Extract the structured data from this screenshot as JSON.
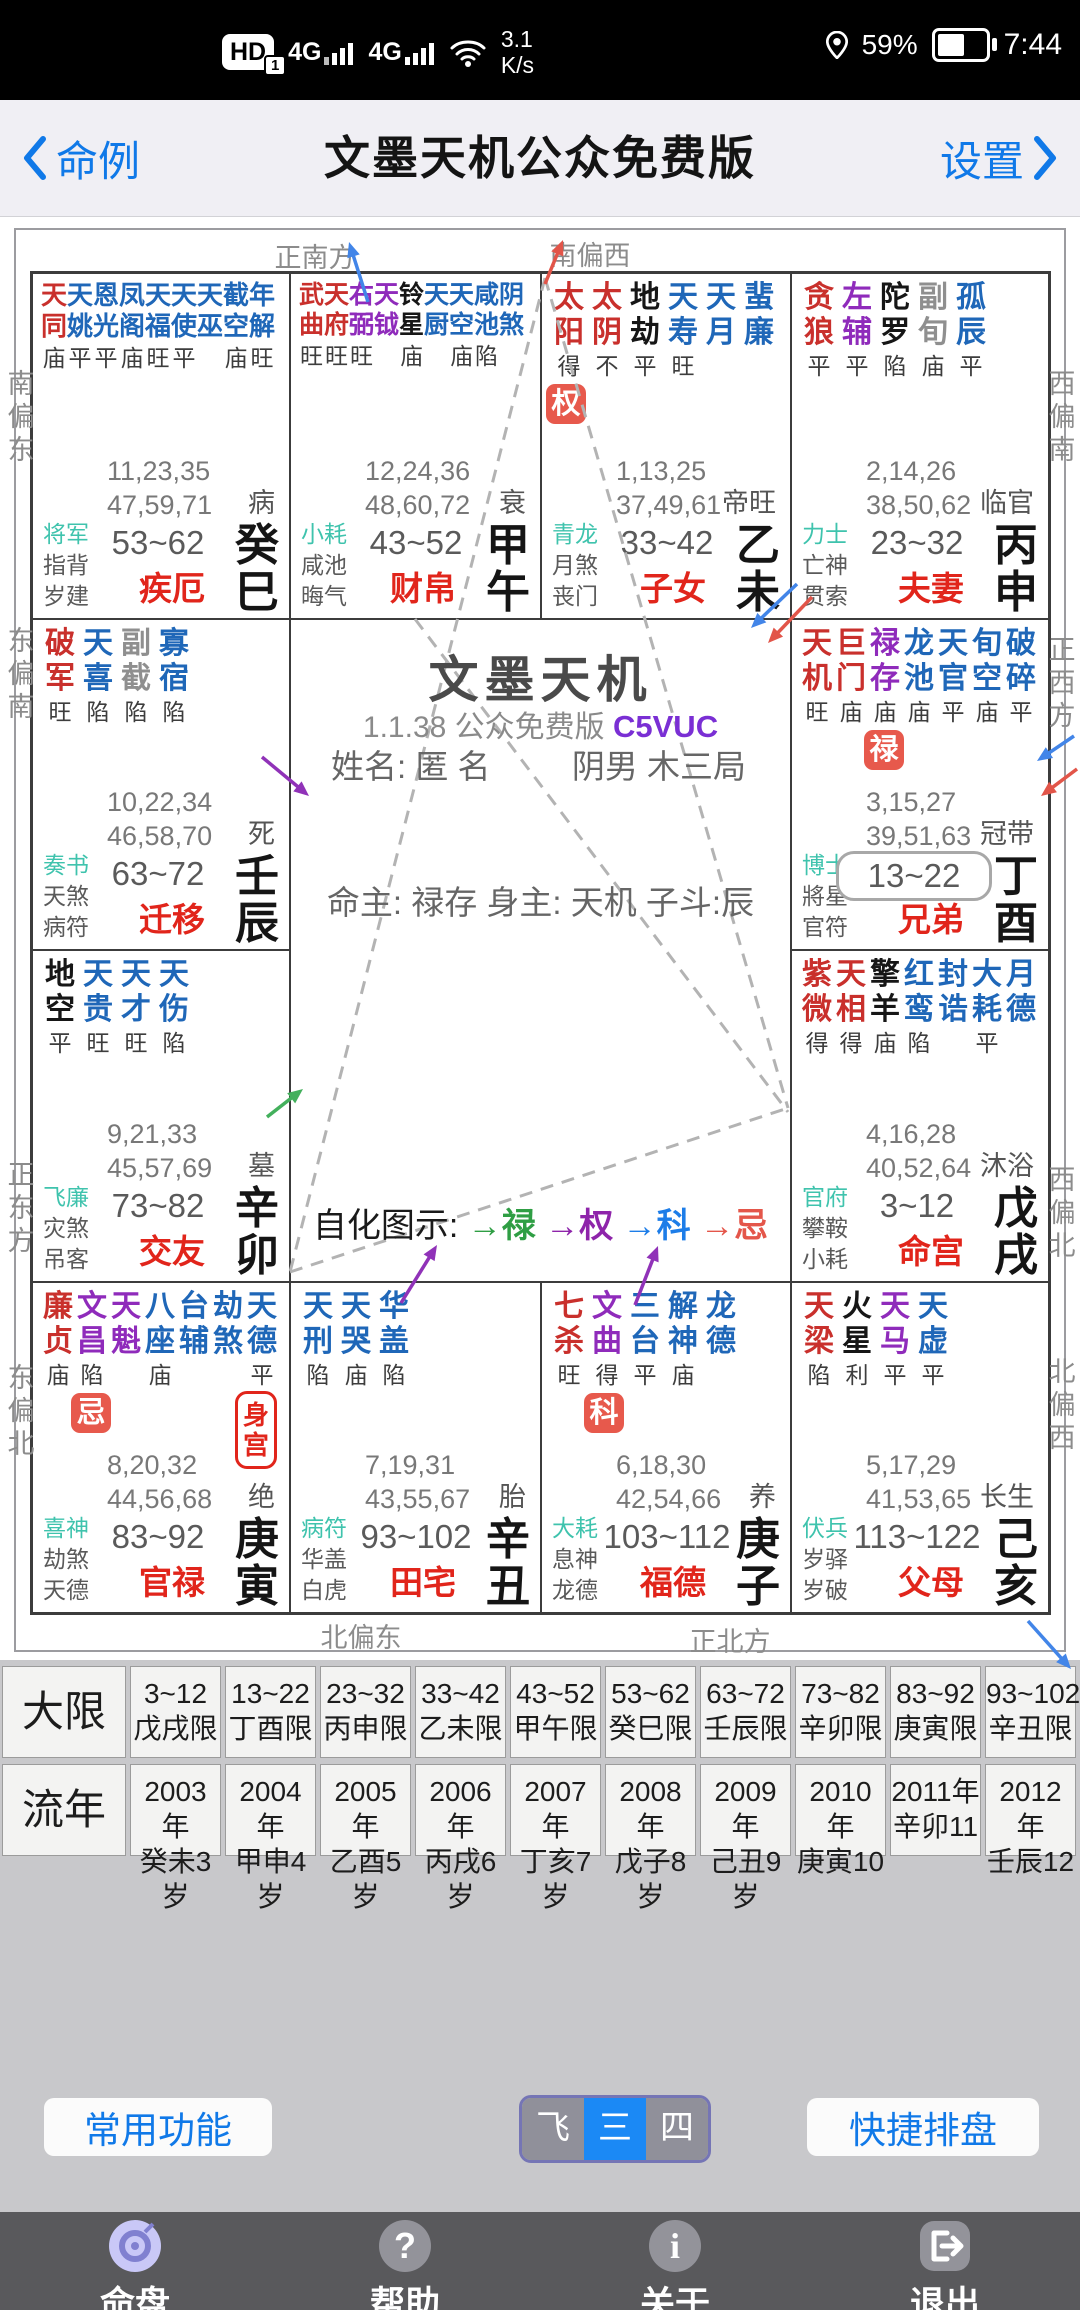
{
  "status_bar": {
    "hd": "HD",
    "hd_sub": "1",
    "net1": "4G",
    "net2": "4G",
    "speed_top": "3.1",
    "speed_bottom": "K/s",
    "battery_pct": "59%",
    "time": "7:44"
  },
  "header": {
    "back": "命例",
    "title": "文墨天机公众免费版",
    "settings": "设置"
  },
  "compass": {
    "top": [
      "正南方",
      "南偏西"
    ],
    "bottom": [
      "北偏东",
      "正北方"
    ],
    "left": [
      "南偏东",
      "东偏南",
      "正东方",
      "东偏北"
    ],
    "right": [
      "西偏南",
      "正西方",
      "西偏北",
      "北偏西"
    ]
  },
  "center": {
    "app_title": "文墨天机",
    "version": "1.1.38 公众免费版",
    "code": "C5VUC",
    "name_label": "姓名:",
    "name": "匿 名",
    "gender": "阴男 木三局",
    "ming_line": "命主: 禄存 身主: 天机 子斗:辰",
    "sihua_label": "自化图示:",
    "sihua": [
      {
        "t": "禄",
        "c": "#2f9e44"
      },
      {
        "t": "权",
        "c": "#8e24aa"
      },
      {
        "t": "科",
        "c": "#1d7de8"
      },
      {
        "t": "忌",
        "c": "#e4564a"
      }
    ]
  },
  "palaces": [
    {
      "key": "si",
      "stars": [
        [
          "天同",
          "r",
          "庙"
        ],
        [
          "天姚",
          "b",
          "平"
        ],
        [
          "恩光",
          "b",
          "平"
        ],
        [
          "凤阁",
          "b",
          "庙"
        ],
        [
          "天福",
          "b",
          "旺"
        ],
        [
          "天使",
          "b",
          "平"
        ],
        [
          "天巫",
          "b",
          ""
        ],
        [
          "截空",
          "b",
          "庙"
        ],
        [
          "年解",
          "b",
          "旺"
        ]
      ],
      "nums": [
        "11,23,35",
        "47,59,71"
      ],
      "stage": "病",
      "gods": [
        "将军",
        "指背",
        "岁建"
      ],
      "age": "53~62",
      "palace": "疾厄",
      "gz": "癸巳"
    },
    {
      "key": "wu",
      "stars": [
        [
          "武曲",
          "r",
          "旺"
        ],
        [
          "天府",
          "r",
          "旺"
        ],
        [
          "右弼",
          "p",
          "旺"
        ],
        [
          "天钺",
          "p",
          ""
        ],
        [
          "铃星",
          "k",
          "庙"
        ],
        [
          "天厨",
          "b",
          ""
        ],
        [
          "天空",
          "b",
          "庙"
        ],
        [
          "咸池",
          "b",
          "陷"
        ],
        [
          "阴煞",
          "b",
          ""
        ]
      ],
      "nums": [
        "12,24,36",
        "48,60,72"
      ],
      "stage": "衰",
      "gods": [
        "小耗",
        "咸池",
        "晦气"
      ],
      "age": "43~52",
      "palace": "财帛",
      "gz": "甲午"
    },
    {
      "key": "wei",
      "stars": [
        [
          "太阳",
          "r",
          "得"
        ],
        [
          "太阴",
          "r",
          "不"
        ],
        [
          "地劫",
          "k",
          "平"
        ],
        [
          "天寿",
          "b",
          "旺"
        ],
        [
          "天月",
          "b",
          ""
        ],
        [
          "蜚廉",
          "b",
          ""
        ]
      ],
      "badge": {
        "t": "权",
        "col": 0
      },
      "nums": [
        "1,13,25",
        "37,49,61"
      ],
      "stage": "帝旺",
      "gods": [
        "青龙",
        "月煞",
        "丧门"
      ],
      "age": "33~42",
      "palace": "子女",
      "gz": "乙未"
    },
    {
      "key": "shen",
      "stars": [
        [
          "贪狼",
          "r",
          "平"
        ],
        [
          "左辅",
          "p",
          "平"
        ],
        [
          "陀罗",
          "k",
          "陷"
        ],
        [
          "副旬",
          "g",
          "庙"
        ],
        [
          "孤辰",
          "b",
          "平"
        ]
      ],
      "nums": [
        "2,14,26",
        "38,50,62"
      ],
      "stage": "临官",
      "gods": [
        "力士",
        "亡神",
        "贯索"
      ],
      "age": "23~32",
      "palace": "夫妻",
      "gz": "丙申"
    },
    {
      "key": "chen",
      "stars": [
        [
          "破军",
          "r",
          "旺"
        ],
        [
          "天喜",
          "b",
          "陷"
        ],
        [
          "副截",
          "g",
          "陷"
        ],
        [
          "寡宿",
          "b",
          "陷"
        ]
      ],
      "nums": [
        "10,22,34",
        "46,58,70"
      ],
      "stage": "死",
      "gods": [
        "奏书",
        "天煞",
        "病符"
      ],
      "age": "63~72",
      "palace": "迁移",
      "gz": "壬辰"
    },
    {
      "key": "you",
      "stars": [
        [
          "天机",
          "r",
          "旺"
        ],
        [
          "巨门",
          "r",
          "庙"
        ],
        [
          "禄存",
          "p",
          "庙"
        ],
        [
          "龙池",
          "b",
          "庙"
        ],
        [
          "天官",
          "b",
          "平"
        ],
        [
          "旬空",
          "b",
          "庙"
        ],
        [
          "破碎",
          "b",
          "平"
        ]
      ],
      "badge": {
        "t": "禄",
        "col": 2
      },
      "age_box": true,
      "nums": [
        "3,15,27",
        "39,51,63"
      ],
      "stage": "冠带",
      "gods": [
        "博士",
        "將星",
        "官符"
      ],
      "age": "13~22",
      "palace": "兄弟",
      "gz": "丁酉"
    },
    {
      "key": "mao",
      "stars": [
        [
          "地空",
          "k",
          "平"
        ],
        [
          "天贵",
          "b",
          "旺"
        ],
        [
          "天才",
          "b",
          "旺"
        ],
        [
          "天伤",
          "b",
          "陷"
        ]
      ],
      "nums": [
        "9,21,33",
        "45,57,69"
      ],
      "stage": "墓",
      "gods": [
        "飞廉",
        "灾煞",
        "吊客"
      ],
      "age": "73~82",
      "palace": "交友",
      "gz": "辛卯"
    },
    {
      "key": "xu",
      "stars": [
        [
          "紫微",
          "r",
          "得"
        ],
        [
          "天相",
          "r",
          "得"
        ],
        [
          "擎羊",
          "k",
          "庙"
        ],
        [
          "红鸾",
          "b",
          "陷"
        ],
        [
          "封诰",
          "b",
          ""
        ],
        [
          "大耗",
          "b",
          "平"
        ],
        [
          "月德",
          "b",
          ""
        ]
      ],
      "nums": [
        "4,16,28",
        "40,52,64"
      ],
      "stage": "沐浴",
      "gods": [
        "官府",
        "攀鞍",
        "小耗"
      ],
      "age": "3~12",
      "palace": "命宫",
      "gz": "戊戌"
    },
    {
      "key": "yin",
      "stars": [
        [
          "廉贞",
          "r",
          "庙"
        ],
        [
          "文昌",
          "p",
          "陷"
        ],
        [
          "天魁",
          "p",
          ""
        ],
        [
          "八座",
          "b",
          "庙"
        ],
        [
          "台辅",
          "b",
          ""
        ],
        [
          "劫煞",
          "b",
          ""
        ],
        [
          "天德",
          "b",
          "平"
        ]
      ],
      "badge": {
        "t": "忌",
        "col": 1
      },
      "shen_gong": "身宫",
      "nums": [
        "8,20,32",
        "44,56,68"
      ],
      "stage": "绝",
      "gods": [
        "喜神",
        "劫煞",
        "天德"
      ],
      "age": "83~92",
      "palace": "官禄",
      "gz": "庚寅"
    },
    {
      "key": "chou",
      "stars": [
        [
          "天刑",
          "b",
          "陷"
        ],
        [
          "天哭",
          "b",
          "庙"
        ],
        [
          "华盖",
          "b",
          "陷"
        ]
      ],
      "nums": [
        "7,19,31",
        "43,55,67"
      ],
      "stage": "胎",
      "gods": [
        "病符",
        "华盖",
        "白虎"
      ],
      "age": "93~102",
      "palace": "田宅",
      "gz": "辛丑"
    },
    {
      "key": "zi",
      "stars": [
        [
          "七杀",
          "r",
          "旺"
        ],
        [
          "文曲",
          "p",
          "得"
        ],
        [
          "三台",
          "b",
          "平"
        ],
        [
          "解神",
          "b",
          "庙"
        ],
        [
          "龙德",
          "b",
          ""
        ]
      ],
      "badge": {
        "t": "科",
        "col": 1
      },
      "nums": [
        "6,18,30",
        "42,54,66"
      ],
      "stage": "养",
      "gods": [
        "大耗",
        "息神",
        "龙德"
      ],
      "age": "103~112",
      "palace": "福德",
      "gz": "庚子"
    },
    {
      "key": "hai",
      "stars": [
        [
          "天梁",
          "r",
          "陷"
        ],
        [
          "火星",
          "k",
          "利"
        ],
        [
          "天马",
          "p",
          "平"
        ],
        [
          "天虚",
          "b",
          "平"
        ]
      ],
      "nums": [
        "5,17,29",
        "41,53,65"
      ],
      "stage": "长生",
      "gods": [
        "伏兵",
        "岁驿",
        "岁破"
      ],
      "age": "113~122",
      "palace": "父母",
      "gz": "己亥"
    }
  ],
  "daxian": {
    "label": "大限",
    "cells": [
      [
        "3~12",
        "戊戌限"
      ],
      [
        "13~22",
        "丁酉限"
      ],
      [
        "23~32",
        "丙申限"
      ],
      [
        "33~42",
        "乙未限"
      ],
      [
        "43~52",
        "甲午限"
      ],
      [
        "53~62",
        "癸巳限"
      ],
      [
        "63~72",
        "壬辰限"
      ],
      [
        "73~82",
        "辛卯限"
      ],
      [
        "83~92",
        "庚寅限"
      ],
      [
        "93~102",
        "辛丑限"
      ]
    ]
  },
  "liunian": {
    "label": "流年",
    "cells": [
      [
        "2003年",
        "癸未3岁"
      ],
      [
        "2004年",
        "甲申4岁"
      ],
      [
        "2005年",
        "乙酉5岁"
      ],
      [
        "2006年",
        "丙戌6岁"
      ],
      [
        "2007年",
        "丁亥7岁"
      ],
      [
        "2008年",
        "戊子8岁"
      ],
      [
        "2009年",
        "己丑9岁"
      ],
      [
        "2010年",
        "庚寅10"
      ],
      [
        "2011年",
        "辛卯11"
      ],
      [
        "2012年",
        "壬辰12"
      ]
    ]
  },
  "toolbar": {
    "left": "常用功能",
    "segments": [
      "飞星",
      "三合",
      "四化"
    ],
    "segment_keys": [
      "feixing",
      "sanhe",
      "sihua"
    ],
    "selected": 1,
    "right": "快捷排盘"
  },
  "nav": [
    {
      "label": "命盘",
      "icon": "chart-disc-icon"
    },
    {
      "label": "帮助",
      "icon": "question-icon"
    },
    {
      "label": "关于",
      "icon": "info-icon"
    },
    {
      "label": "退出",
      "icon": "exit-icon"
    }
  ],
  "colors": {
    "star_red": "#c9302c",
    "star_blue": "#1f67b8",
    "star_purple": "#8f2bbb",
    "star_black": "#161616",
    "star_gray": "#8f8f8f",
    "badge_bg": "#e7594c",
    "palace_red": "#e1251b",
    "teal": "#3fc3ad",
    "blue_accent": "#1079e8",
    "seg_selected": "#1b89f5",
    "seg_unselected": "#90909a",
    "arrow_blue": "#4285e8",
    "arrow_red": "#e25549",
    "arrow_purple": "#9032b8",
    "arrow_green": "#43b05c"
  }
}
